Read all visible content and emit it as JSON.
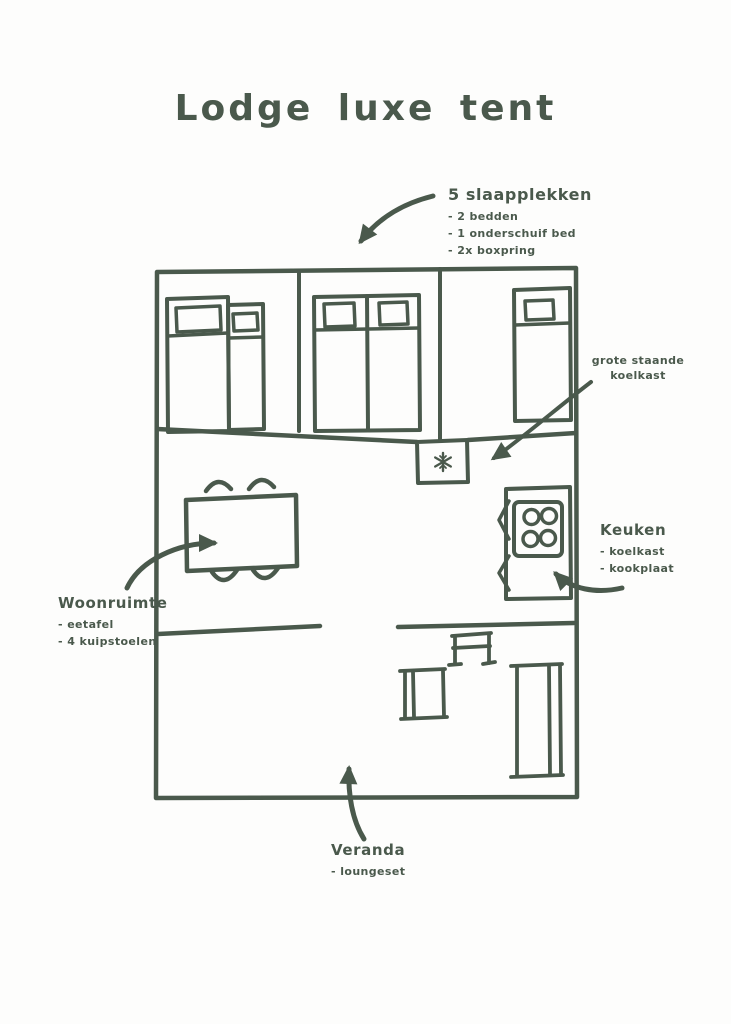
{
  "page": {
    "background": "#fdfdfc",
    "ink_color": "#4a594c"
  },
  "title": "Lodge luxe tent",
  "annotations": {
    "sleeping": {
      "heading": "5 slaapplekken",
      "items": [
        "- 2 bedden",
        "- 1 onderschuif bed",
        "- 2x boxpring"
      ]
    },
    "fridge": {
      "line1": "grote staande",
      "line2": "koelkast"
    },
    "kitchen": {
      "heading": "Keuken",
      "items": [
        "- koelkast",
        "- kookplaat"
      ]
    },
    "living": {
      "heading": "Woonruimte",
      "items": [
        "- eetafel",
        "- 4 kuipstoelen"
      ]
    },
    "veranda": {
      "heading": "Veranda",
      "items": [
        "- loungeset"
      ]
    }
  },
  "plan": {
    "rooms": [
      "slaapkamer-links",
      "slaapkamer-midden",
      "slaapkamer-rechts",
      "woonruimte",
      "keuken",
      "veranda"
    ],
    "furniture": [
      "bed-large",
      "bed-pullout",
      "bed-double",
      "bed-single",
      "fridge",
      "stove-4-burners",
      "dining-table",
      "4-chairs",
      "lounge-chair",
      "lounge-table",
      "lounge-sofa"
    ],
    "fridge_icon": "snowflake-icon",
    "burner_count": 4
  }
}
